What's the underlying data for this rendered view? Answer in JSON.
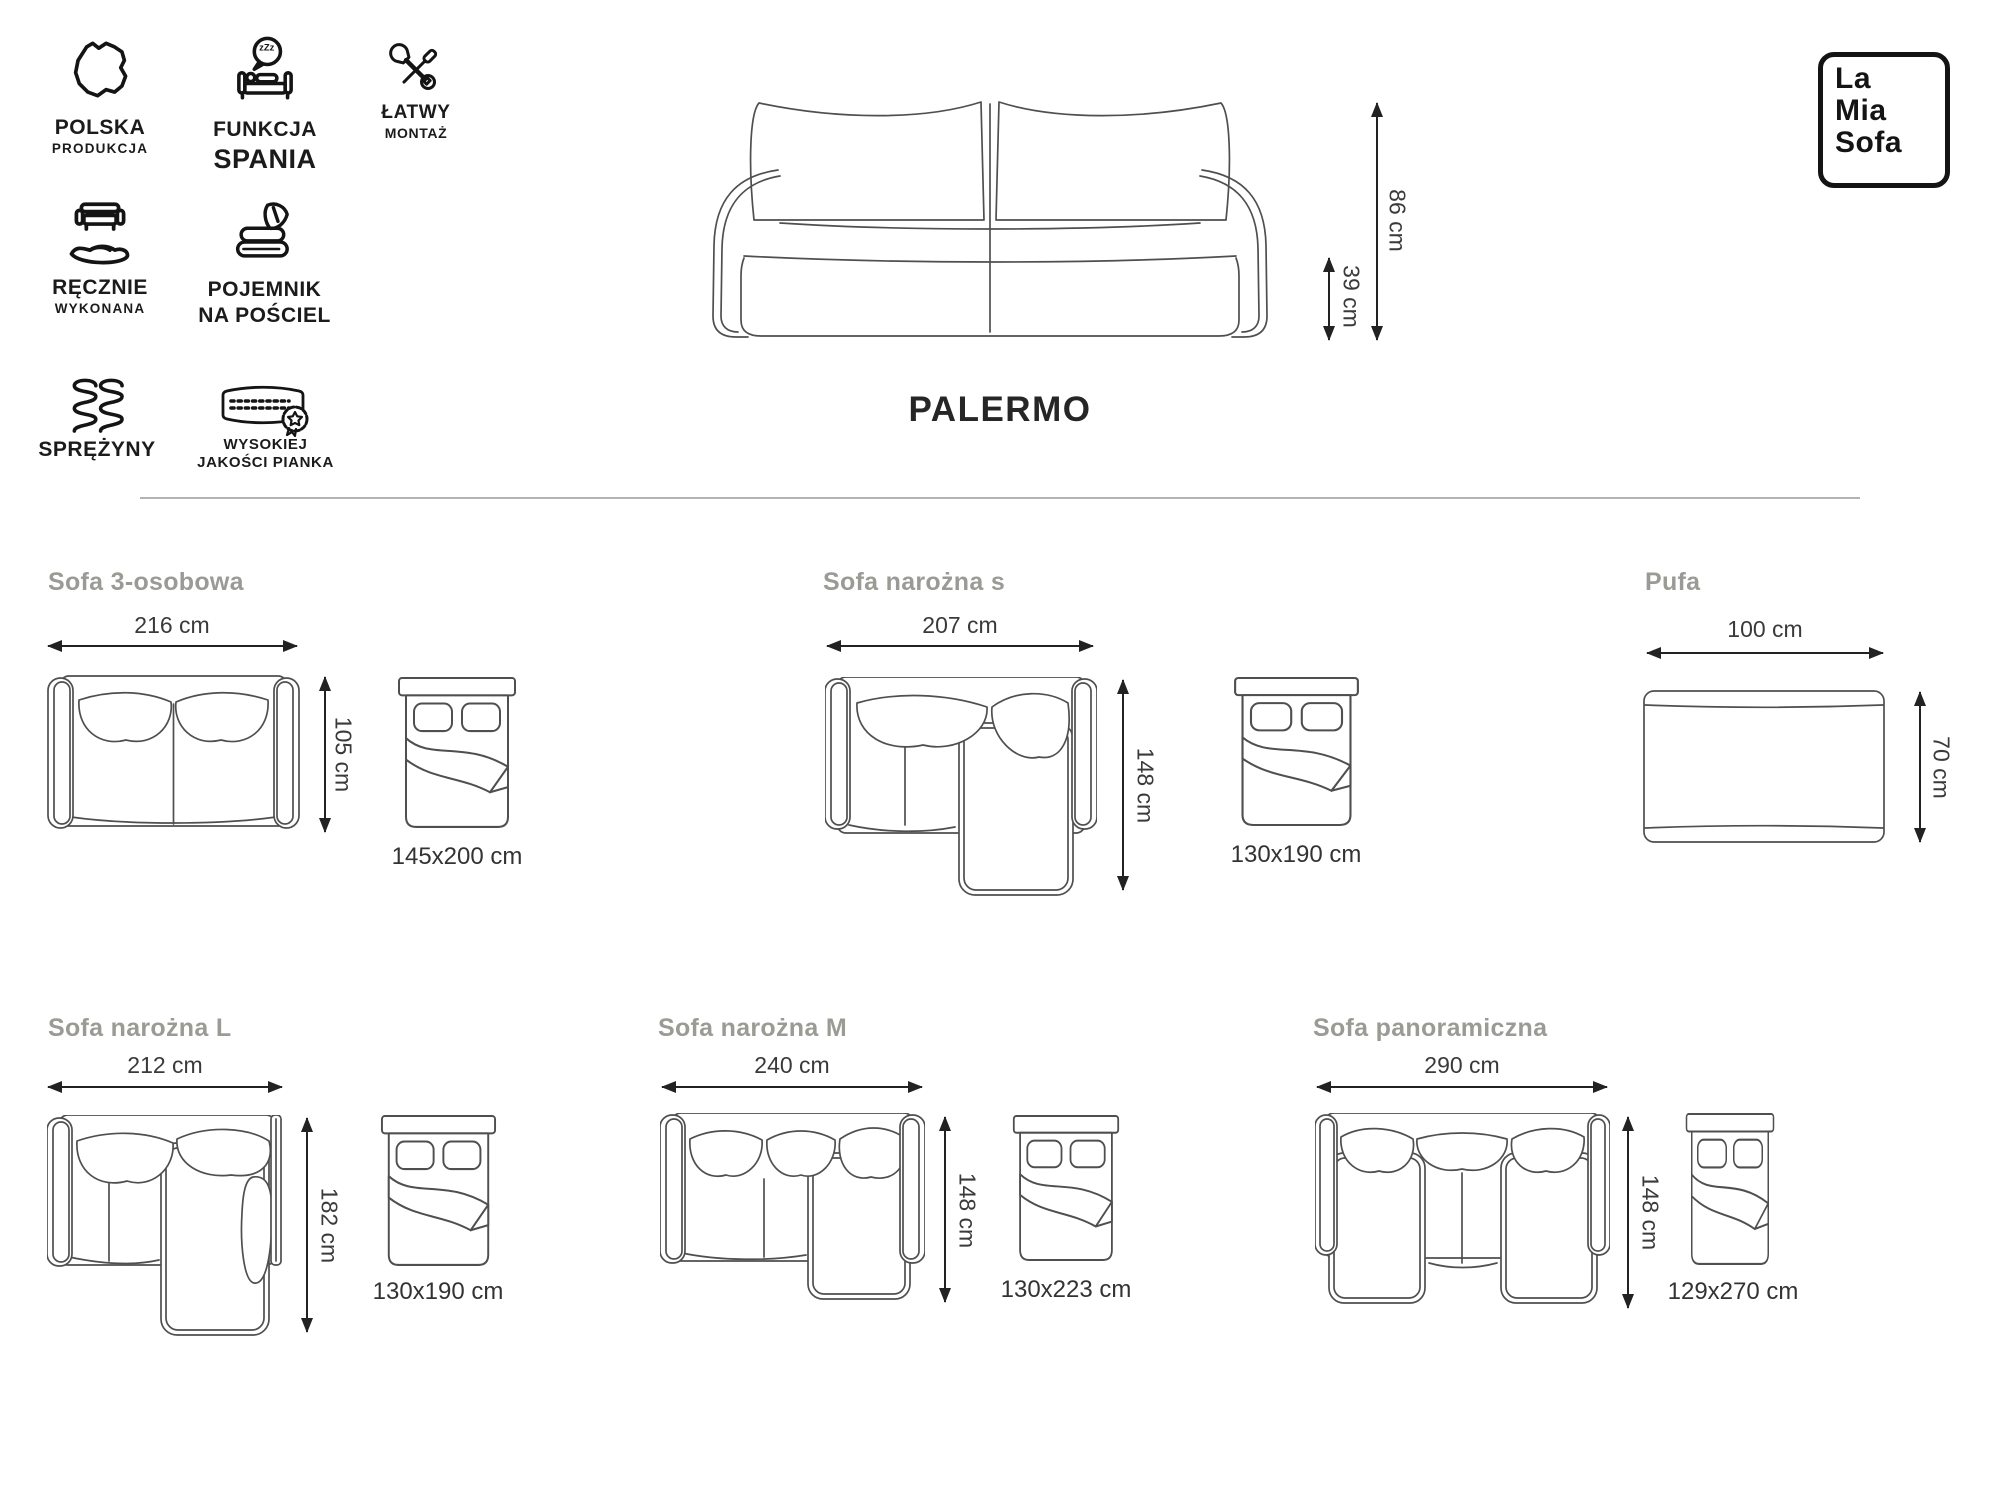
{
  "brand": {
    "lines": [
      "La",
      "Mia",
      "Sofa"
    ]
  },
  "features": [
    {
      "icon": "poland-map-icon",
      "line1": "POLSKA",
      "line2": "PRODUKCJA"
    },
    {
      "icon": "sleep-function-icon",
      "line1": "FUNKCJA",
      "line2": "SPANIA",
      "bubble": "zZz"
    },
    {
      "icon": "tools-icon",
      "line1": "ŁATWY",
      "line2": "MONTAŻ"
    },
    {
      "icon": "handmade-icon",
      "line1": "RĘCZNIE",
      "line2": "WYKONANA"
    },
    {
      "icon": "bedding-container-icon",
      "line1": "POJEMNIK",
      "line2": "NA POŚCIEL"
    },
    {
      "icon": "springs-icon",
      "line1": "SPRĘŻYNY",
      "line2": ""
    },
    {
      "icon": "foam-icon",
      "line1": "WYSOKIEJ",
      "line2": "JAKOŚCI PIANKA"
    }
  ],
  "product": {
    "title": "PALERMO",
    "total_height": "86 cm",
    "seat_height": "39 cm"
  },
  "variants": [
    {
      "name": "Sofa 3-osobowa",
      "width": "216 cm",
      "depth": "105 cm",
      "bed_size": "145x200 cm"
    },
    {
      "name": "Sofa narożna s",
      "width": "207 cm",
      "depth": "148 cm",
      "bed_size": "130x190 cm"
    },
    {
      "name": "Pufa",
      "width": "100 cm",
      "depth": "70 cm"
    },
    {
      "name": "Sofa narożna L",
      "width": "212 cm",
      "depth": "182 cm",
      "bed_size": "130x190 cm"
    },
    {
      "name": "Sofa narożna M",
      "width": "240 cm",
      "depth": "148 cm",
      "bed_size": "130x223 cm"
    },
    {
      "name": "Sofa panoramiczna",
      "width": "290 cm",
      "depth": "148 cm",
      "bed_size": "129x270 cm"
    }
  ],
  "colors": {
    "line": "#4f4f4f",
    "icon": "#141414",
    "title_gray": "#9b9b95",
    "dim_text": "#3a3a3a",
    "divider": "#b3b3b0"
  }
}
